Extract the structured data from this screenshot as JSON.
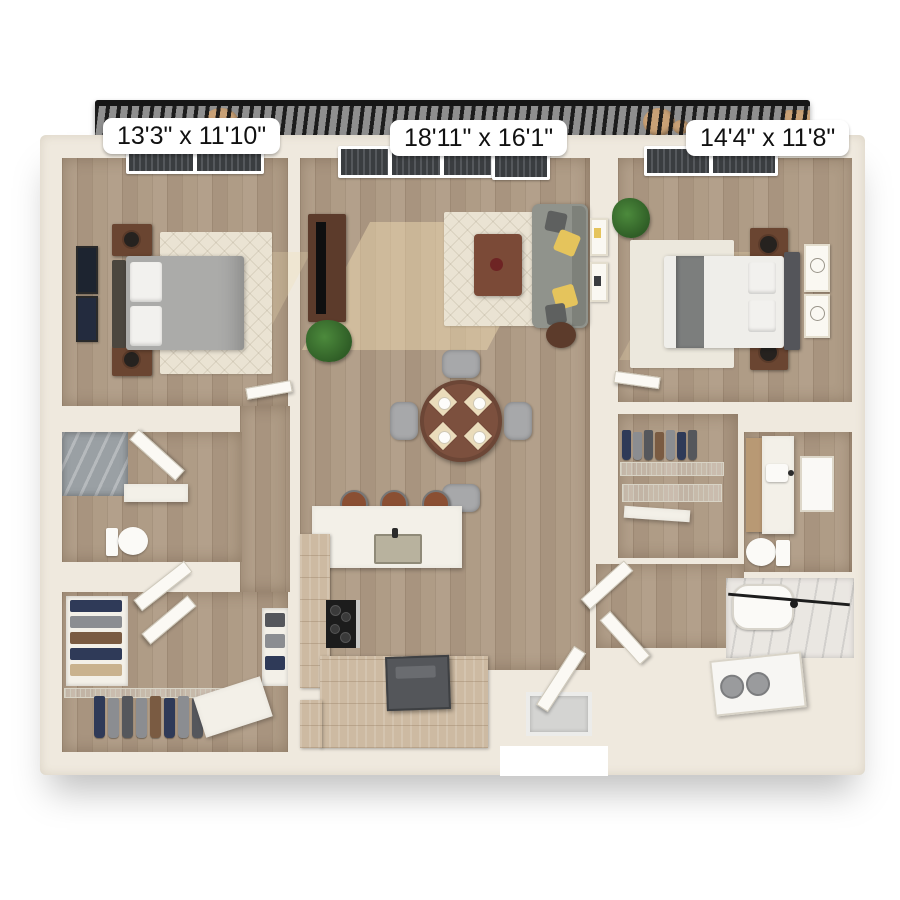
{
  "meta": {
    "view": "3d-top-down-floor-plan",
    "background": "#FFFFFF"
  },
  "rooms": [
    {
      "id": "bedroom-1",
      "dimensions": "13'3\" x 11'10\"",
      "features": [
        "window",
        "queen-bed",
        "two-nightstands",
        "two-lamps",
        "area-rug",
        "two-wall-frames"
      ]
    },
    {
      "id": "living-dining-kitchen",
      "dimensions": "18'11\" x 16'1\"",
      "features": [
        "balcony-windows",
        "tv-console",
        "plant",
        "area-rug",
        "coffee-table",
        "sofa",
        "side-table",
        "round-dining-table",
        "four-chairs",
        "four-place-settings",
        "peninsula-counter",
        "sink",
        "three-bar-stools",
        "tall-cabinet",
        "cooktop",
        "base-cabinets",
        "refrigerator",
        "entry-mat",
        "entry-door"
      ]
    },
    {
      "id": "bedroom-2",
      "dimensions": "14'4\" x 11'8\"",
      "features": [
        "window",
        "plant",
        "queen-bed",
        "gray-throw",
        "two-nightstands",
        "two-lamps",
        "area-rug",
        "two-wall-frames"
      ]
    }
  ],
  "other_areas": [
    {
      "id": "balcony",
      "features": [
        "metal-railing",
        "outdoor-furniture"
      ]
    },
    {
      "id": "bathroom-1",
      "features": [
        "walk-in-shower",
        "vanity",
        "toilet",
        "door"
      ]
    },
    {
      "id": "walk-in-closet-1",
      "features": [
        "folded-clothes-shelves",
        "hanging-clothes",
        "wire-shelving",
        "island-bench",
        "door"
      ]
    },
    {
      "id": "walk-in-closet-2",
      "features": [
        "hanging-clothes",
        "wire-shelving"
      ]
    },
    {
      "id": "bathroom-2",
      "features": [
        "wood-vanity",
        "sink-counter",
        "mirror",
        "toilet",
        "bathtub",
        "stacked-washer-dryer",
        "doors"
      ]
    }
  ],
  "colors": {
    "wall": "#EFE9DE",
    "floor_wood": "#AB9884",
    "sunlight": "#F0DBB2",
    "balcony_rail": "#161616",
    "balcony_floor": "#8F8F8F",
    "label_bg": "#FFFFFF",
    "label_text": "#111111",
    "dark_wood": "#5C3B2B",
    "nightstand": "#6A4531",
    "sofa_gray": "#90938C",
    "pillow_yellow": "#E5C45C",
    "bed1_duvet": "#ABABA9",
    "bed2_duvet": "#EFEEEA",
    "headboard": "#54555A",
    "dining_table": "#7C503E",
    "chair_gray": "#A7A8AA",
    "counter_white": "#F3F0E8",
    "cabinet_wood": "#CDBAA2",
    "cooktop": "#1C1C1C",
    "appliance_gray": "#54565A",
    "shower_tile": "#9AA0A4",
    "porcelain": "#FBFAF7",
    "cloth_navy": "#2F3A58",
    "cloth_gray": "#8B8D91",
    "cloth_brown": "#7A5B42",
    "plant_green": "#3E7A34",
    "rug_cream": "#EAE3D3"
  }
}
